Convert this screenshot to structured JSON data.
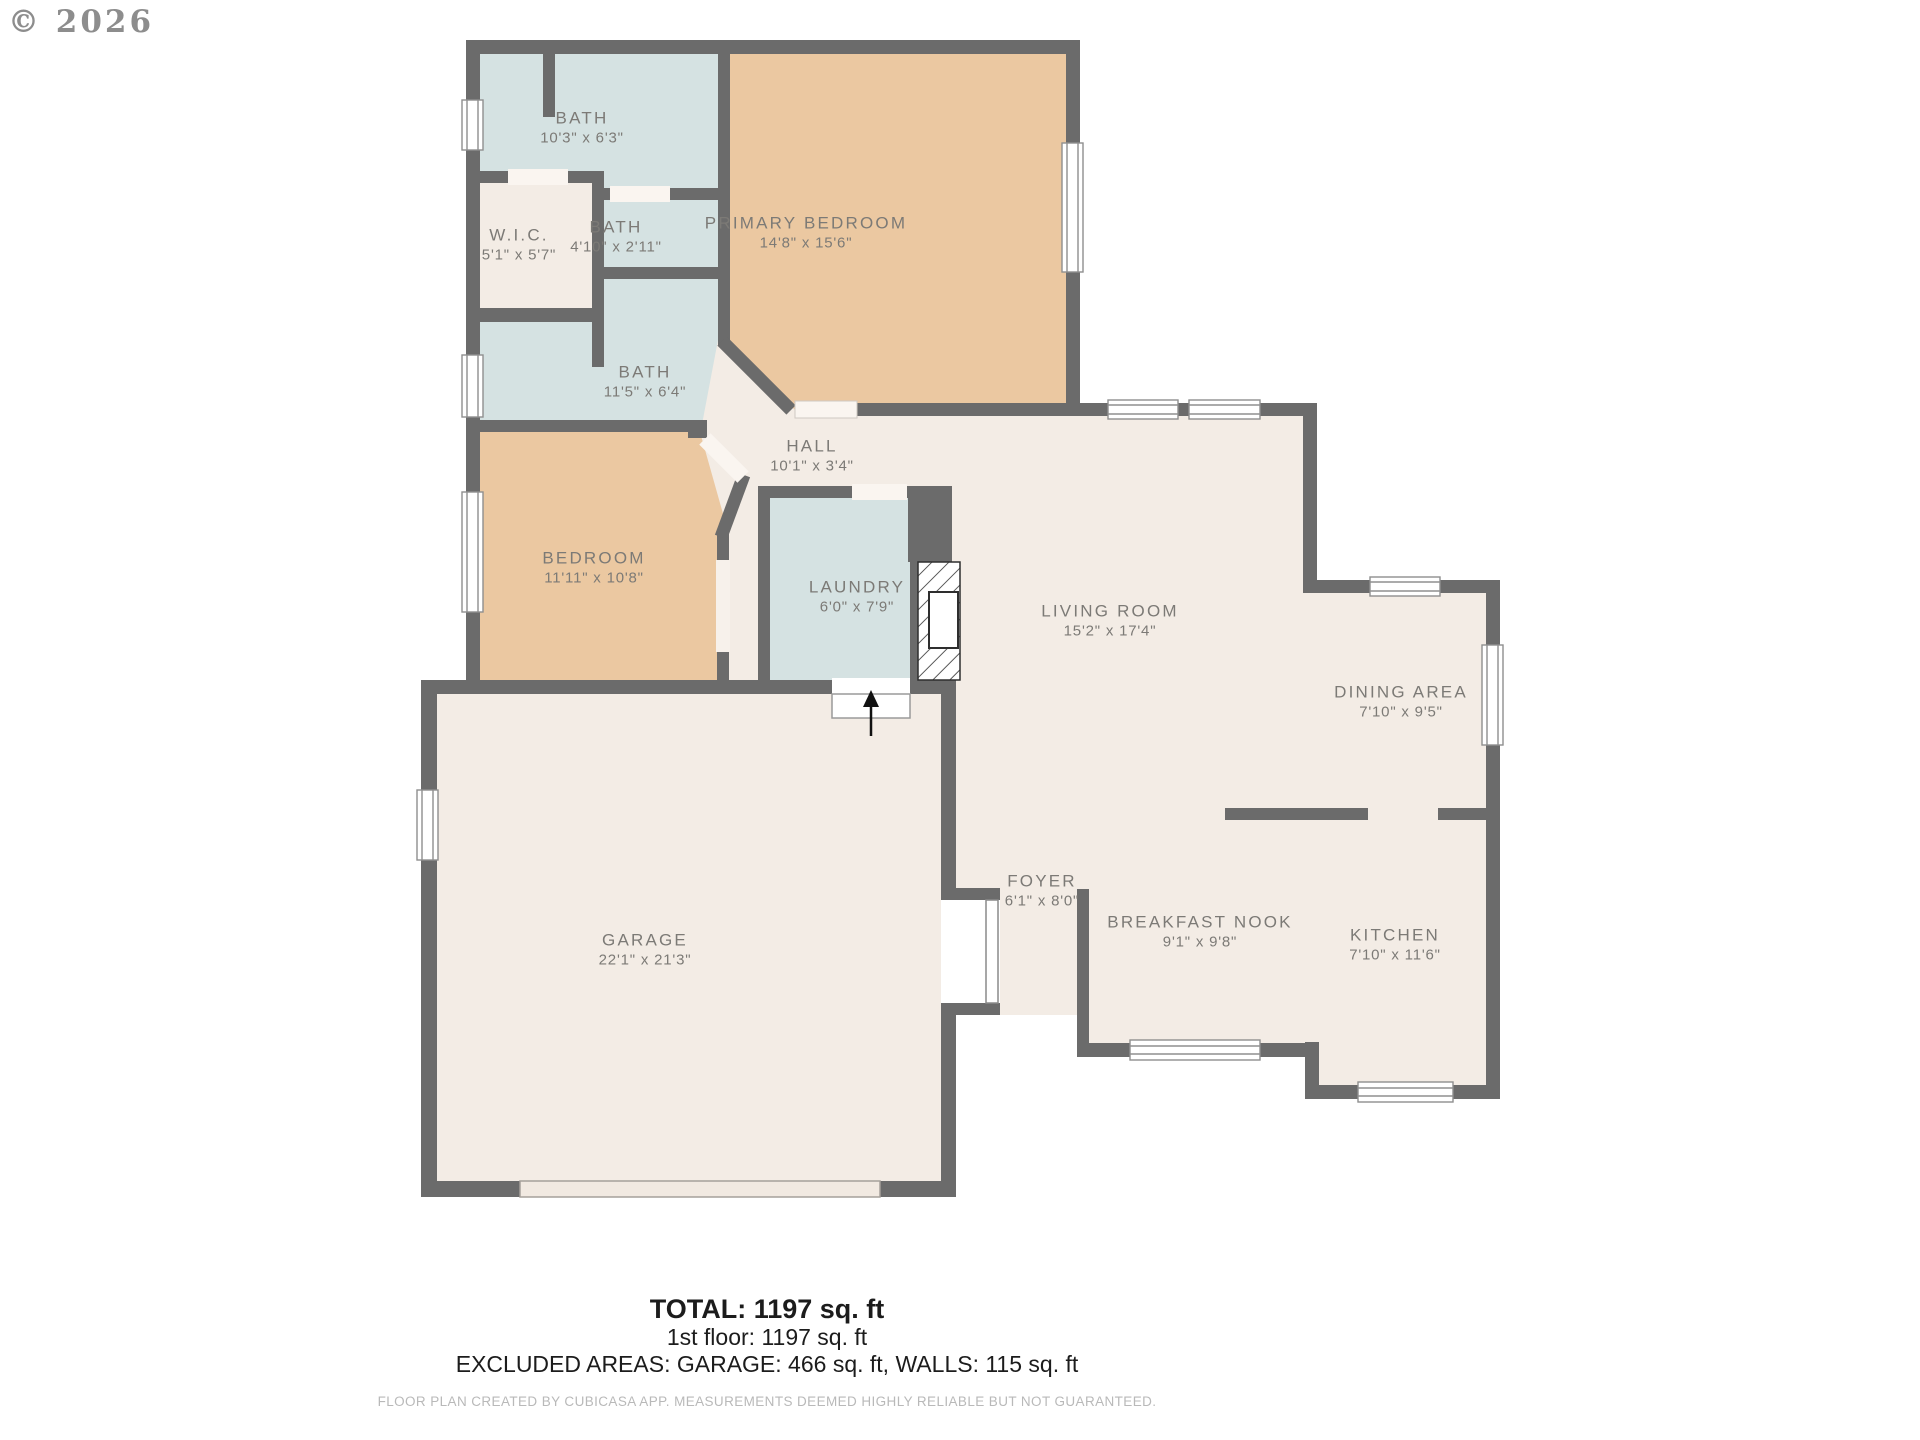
{
  "watermark": "© 2026",
  "rooms": [
    {
      "name": "BATH",
      "dims": "10'3\" x 6'3\""
    },
    {
      "name": "W.I.C.",
      "dims": "5'1\" x 5'7\""
    },
    {
      "name": "BATH",
      "dims": "4'10\" x 2'11\""
    },
    {
      "name": "PRIMARY BEDROOM",
      "dims": "14'8\" x 15'6\""
    },
    {
      "name": "BATH",
      "dims": "11'5\" x 6'4\""
    },
    {
      "name": "HALL",
      "dims": "10'1\" x 3'4\""
    },
    {
      "name": "BEDROOM",
      "dims": "11'11\" x 10'8\""
    },
    {
      "name": "LAUNDRY",
      "dims": "6'0\" x 7'9\""
    },
    {
      "name": "LIVING ROOM",
      "dims": "15'2\" x 17'4\""
    },
    {
      "name": "DINING AREA",
      "dims": "7'10\" x 9'5\""
    },
    {
      "name": "FOYER",
      "dims": "6'1\" x 8'0\""
    },
    {
      "name": "BREAKFAST NOOK",
      "dims": "9'1\" x 9'8\""
    },
    {
      "name": "KITCHEN",
      "dims": "7'10\" x 11'6\""
    },
    {
      "name": "GARAGE",
      "dims": "22'1\" x 21'3\""
    }
  ],
  "summary": {
    "total": "TOTAL: 1197 sq. ft",
    "floor": "1st floor: 1197 sq. ft",
    "excluded": "EXCLUDED AREAS: GARAGE: 466 sq. ft, WALLS: 115 sq. ft"
  },
  "disclaimer": "FLOOR PLAN CREATED BY CUBICASA APP. MEASUREMENTS DEEMED HIGHLY RELIABLE BUT NOT GUARANTEED.",
  "icons": {
    "entry_arrow": "entry-arrow-icon (black up arrow at garage/laundry entry step)",
    "fireplace": "fireplace-hatch (diagonal hatched chimney block with firebox)"
  },
  "colors": {
    "wall": "#6b6b6b",
    "floor_cream": "#f3ece5",
    "room_blue": "#d5e2e2",
    "room_tan": "#ebc8a1",
    "window_white": "#ffffff",
    "label_gray": "#7c7a76",
    "footer_text": "#1c1c1c",
    "disclaimer_gray": "#b9b9b9",
    "watermark_gray": "#8d8d8d"
  }
}
